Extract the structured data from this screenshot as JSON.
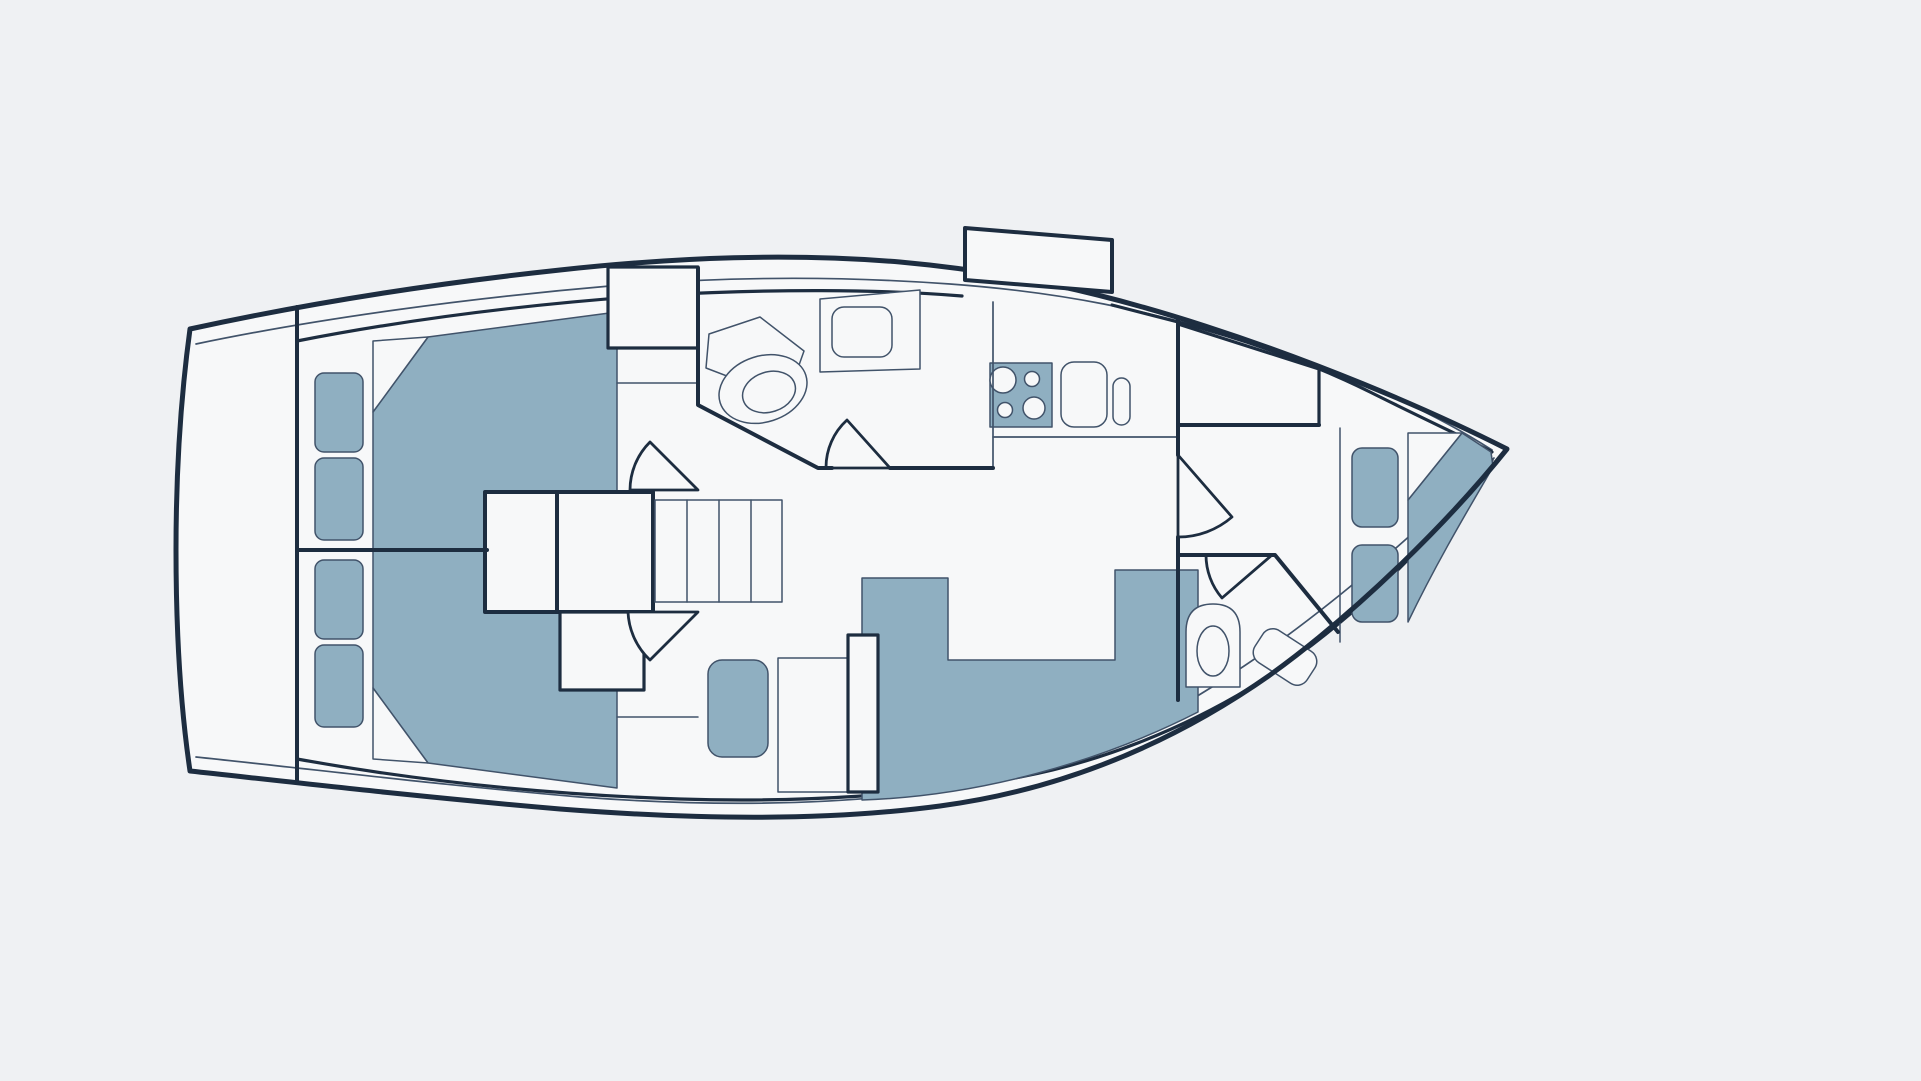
{
  "page": {
    "title": "Sailboat interior deck plan",
    "type": "floor-plan-diagram",
    "orientation": "bow-right-stern-left",
    "visible_text": []
  },
  "colors": {
    "bg": "#eff1f3",
    "paper": "#f7f8f9",
    "line": "#1d2d40",
    "thin": "#41536a",
    "blue": "#8fafc1"
  },
  "rooms": [
    {
      "name": "aft-cabin-port",
      "position": "stern-top",
      "furniture": [
        "double-berth-with-folded-sheet",
        "locker-cushion",
        "locker-cushion",
        "hanging-closet",
        "door-swing"
      ]
    },
    {
      "name": "aft-cabin-starboard",
      "position": "stern-bottom",
      "furniture": [
        "double-berth-with-folded-sheet",
        "locker-cushion",
        "locker-cushion",
        "shelf",
        "door-swing"
      ]
    },
    {
      "name": "companionway",
      "position": "center-left",
      "furniture": [
        "engine-box",
        "companionway-stairs-4-treads",
        "stowage-box",
        "sliding-hatch-garage"
      ]
    },
    {
      "name": "aft-head",
      "position": "top-center",
      "furniture": [
        "toilet",
        "sink-counter",
        "door-swing",
        "angled-wall"
      ]
    },
    {
      "name": "galley",
      "position": "top-center-right",
      "furniture": [
        "stove-4-burner",
        "sink",
        "small-basin"
      ]
    },
    {
      "name": "salon",
      "position": "center",
      "furniture": [
        "u-shaped-settee",
        "table",
        "folding-table-leaf",
        "single-seat"
      ]
    },
    {
      "name": "forward-head",
      "position": "bottom-right",
      "furniture": [
        "toilet",
        "sink-angled",
        "door-swing",
        "angled-wall"
      ]
    },
    {
      "name": "forward-cabin",
      "position": "bow",
      "furniture": [
        "v-berth-with-folded-sheet",
        "seat-cushion",
        "seat-cushion",
        "hanging-closet",
        "door-swing"
      ]
    }
  ]
}
